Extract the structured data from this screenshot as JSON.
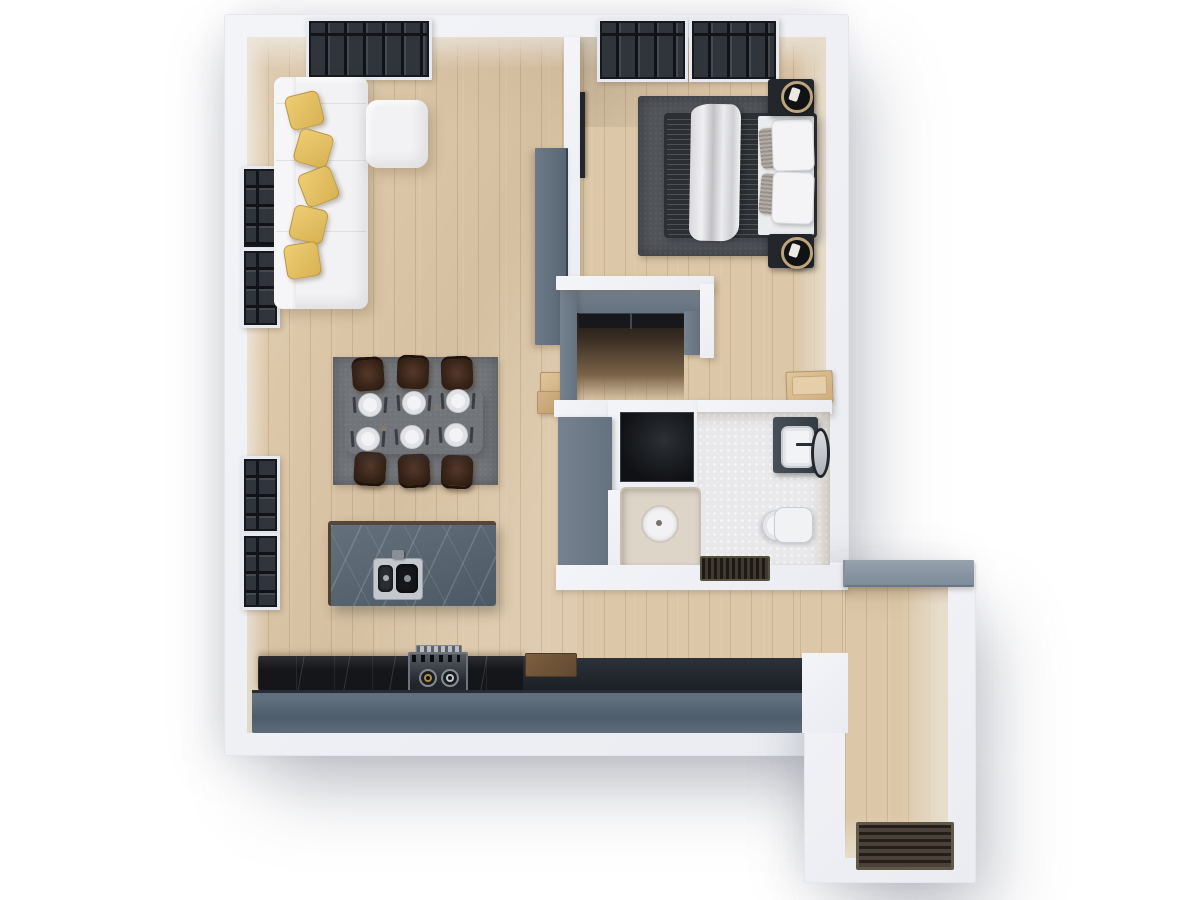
{
  "scene": {
    "type": "3d-floor-plan-render",
    "view": "top-down",
    "background": "#ffffff",
    "canvas": {
      "width": 1200,
      "height": 900
    },
    "text_visible": "none"
  },
  "palette": {
    "exterior_wall": "#f0f1f5",
    "interior_wall_face": "#e7ded1",
    "partition_gray": "#6e7c8b",
    "wood_floor": "#dcc7a8",
    "wood_plank_line": "#8c6a46",
    "bathroom_tile": "#e9e9eb",
    "counter_front": "#566574",
    "black_marble": "#15161a",
    "island_marble": "#576370",
    "sofa_white": "#f2f2f4",
    "pillow_yellow": "#e3bd62",
    "chair_brown": "#38241b",
    "rug_dining": "#717478",
    "rug_bedroom": "#515459",
    "window_frame": "#30353c",
    "lamp_gold": "#bda47c",
    "shower_beige": "#ddd5c8",
    "doormat_brown": "#4a4138"
  },
  "rooms": [
    {
      "id": "living-room",
      "label": "living room",
      "furniture": [
        "sectional-sofa",
        "ottoman",
        "throw-pillows x5",
        "media-cabinet",
        "side-stool",
        "wall-windows x2",
        "top-window x1"
      ]
    },
    {
      "id": "dining-area",
      "label": "dining area",
      "furniture": [
        "dining-table",
        "dining-chairs x6",
        "place-settings x6",
        "area-rug"
      ]
    },
    {
      "id": "kitchen",
      "label": "kitchen",
      "furniture": [
        "island-with-double-sink",
        "counter-run",
        "gas-stove",
        "cutting-board",
        "wall-windows x2"
      ]
    },
    {
      "id": "bedroom",
      "label": "bedroom",
      "furniture": [
        "double-bed",
        "draped-blanket",
        "pillows x4",
        "nightstands x2",
        "table-lamps x2",
        "area-rug",
        "wall-tv",
        "top-windows x2",
        "bench"
      ]
    },
    {
      "id": "wardrobe-closet",
      "label": "wardrobe closet",
      "furniture": [
        "clothes-rail"
      ]
    },
    {
      "id": "bathroom",
      "label": "bathroom",
      "furniture": [
        "vanity-with-sink",
        "round-mirror",
        "toilet",
        "shower-tray-with-drain",
        "washer-niche",
        "bath-mat"
      ]
    },
    {
      "id": "entry-hall",
      "label": "entry hall",
      "furniture": [
        "doormat"
      ]
    }
  ],
  "counts": {
    "yellow_pillows": 5,
    "dining_chairs": 6,
    "place_settings": 6,
    "left_wall_windows": 4,
    "top_wall_windows": 3,
    "lamps": 2
  }
}
